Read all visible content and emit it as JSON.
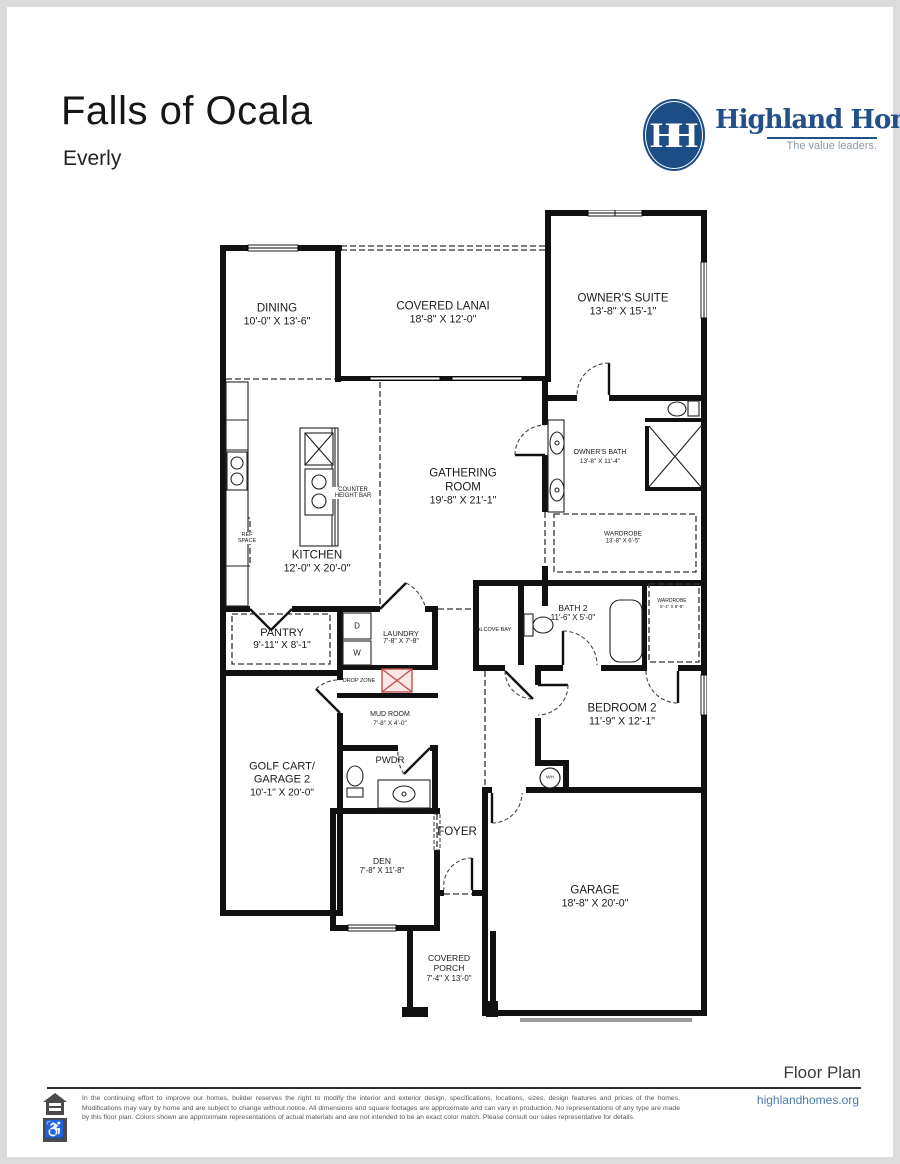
{
  "header": {
    "title": "Falls of Ocala",
    "subtitle": "Everly"
  },
  "logo": {
    "monogram": "HH",
    "name": "Highland Homes",
    "tagline": "The value leaders.",
    "brand_color": "#235089"
  },
  "rooms": {
    "dining": {
      "name": "DINING",
      "dims": "10'-0\" X 13'-6\""
    },
    "covered_lanai": {
      "name": "COVERED LANAI",
      "dims": "18'-8\" X 12'-0\""
    },
    "owners_suite": {
      "name": "OWNER'S SUITE",
      "dims": "13'-8\" X 15'-1\""
    },
    "gathering_room": {
      "name": "GATHERING ROOM",
      "dims": "19'-8\" X 21'-1\""
    },
    "owners_bath": {
      "name": "OWNER'S BATH",
      "dims": "13'-8\" X 11'-4\""
    },
    "wardrobe": {
      "name": "WARDROBE",
      "dims": "13'-8\" X 6'-5\""
    },
    "kitchen": {
      "name": "KITCHEN",
      "dims": "12'-0\" X 20'-0\""
    },
    "pantry": {
      "name": "PANTRY",
      "dims": "9'-11\" X 8'-1\""
    },
    "laundry": {
      "name": "LAUNDRY",
      "dims": "7'-8\" X 7'-8\""
    },
    "bath2": {
      "name": "BATH 2",
      "dims": "11'-6\" X 5'-0\""
    },
    "wardrobe2": {
      "name": "WARDROBE",
      "dims": "5'-1\" X 8'-8\""
    },
    "mud_room": {
      "name": "MUD ROOM",
      "dims": "7'-8\" X 4'-0\""
    },
    "golf_cart_garage": {
      "name": "GOLF CART/ GARAGE 2",
      "dims": "10'-1\" X 20'-0\""
    },
    "pwdr": {
      "name": "PWDR"
    },
    "bedroom2": {
      "name": "BEDROOM 2",
      "dims": "11'-9\" X 12'-1\""
    },
    "foyer": {
      "name": "FOYER"
    },
    "den": {
      "name": "DEN",
      "dims": "7'-8\" X 11'-8\""
    },
    "garage": {
      "name": "GARAGE",
      "dims": "18'-8\" X 20'-0\""
    },
    "covered_porch": {
      "name": "COVERED PORCH",
      "dims": "7'-4\" X 13'-0\""
    }
  },
  "annotations": {
    "counter_height_bar": "COUNTER HEIGHT BAR",
    "ref_space": "REF SPACE",
    "drop_zone": "DROP ZONE",
    "alcove_bay": "ALCOVE BAY",
    "dryer": "D",
    "washer": "W",
    "water_heater": "WH"
  },
  "footer": {
    "label": "Floor Plan",
    "website": "highlandhomes.org",
    "disclaimer": "In the continuing effort to improve our homes, builder reserves the right to modify the interior and exterior design, specifications, locations, sizes, design features and prices of the homes. Modifications may vary by home and are subject to change without notice. All dimensions and square footages are approximate and can vary in production. No representations of any type are made by this floor plan. Colors shown are approximate representations of actual materials and are not intended to be an exact color match. Please consult our sales representative for details."
  }
}
